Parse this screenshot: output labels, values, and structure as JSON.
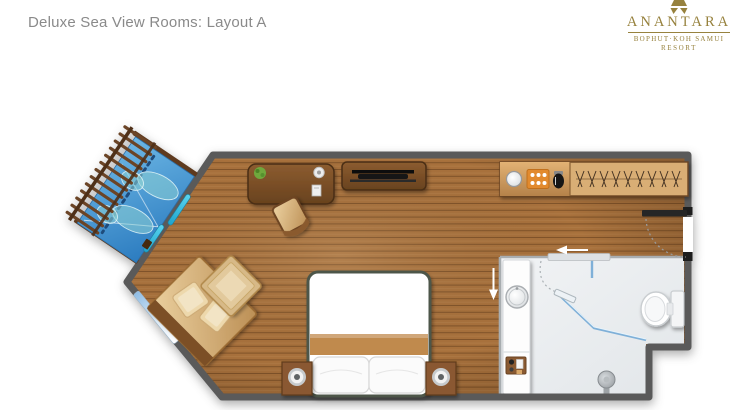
{
  "header": {
    "title": "Deluxe Sea View Rooms: Layout A"
  },
  "logo": {
    "brand": "ANANTARA",
    "location": "BOPHUT·KOH SAMUI",
    "descriptor": "RESORT"
  },
  "palette": {
    "brand_gold": "#97823E",
    "title_gray": "#8A8A8A",
    "wall_gray": "#5A5A5A",
    "wood_brown": "#A8713C",
    "balcony_water_blue": "#3E8FCB",
    "bathroom_floor_gray": "#EAEDEF",
    "tray_orange": "#E28A2D",
    "shower_glass_blue": "#7FB0D8",
    "lounger_teal": "#8FD0D4"
  },
  "floorplan": {
    "areas": [
      "bedroom",
      "balcony",
      "bathroom",
      "wardrobe-corridor"
    ],
    "furniture": [
      "double-bed",
      "bedside-table-left",
      "bedside-table-right",
      "table-lamp-left",
      "table-lamp-right",
      "daybed-sofa",
      "sofa-cushions",
      "ottoman-table",
      "writing-desk",
      "desk-chair",
      "potted-plant",
      "coffee-cup",
      "notepad",
      "tv-console",
      "television",
      "minibar-counter",
      "minibar-sink",
      "coffee-tray",
      "kettle",
      "wardrobe-hangers",
      "sun-lounger-1",
      "sun-lounger-2",
      "pergola-railing",
      "balcony-sliding-door",
      "diagonal-window",
      "vanity-counter",
      "basin",
      "amenity-tray",
      "toilet",
      "shower-enclosure",
      "shower-door",
      "shower-head",
      "entry-door",
      "sliding-door-arrows"
    ]
  }
}
